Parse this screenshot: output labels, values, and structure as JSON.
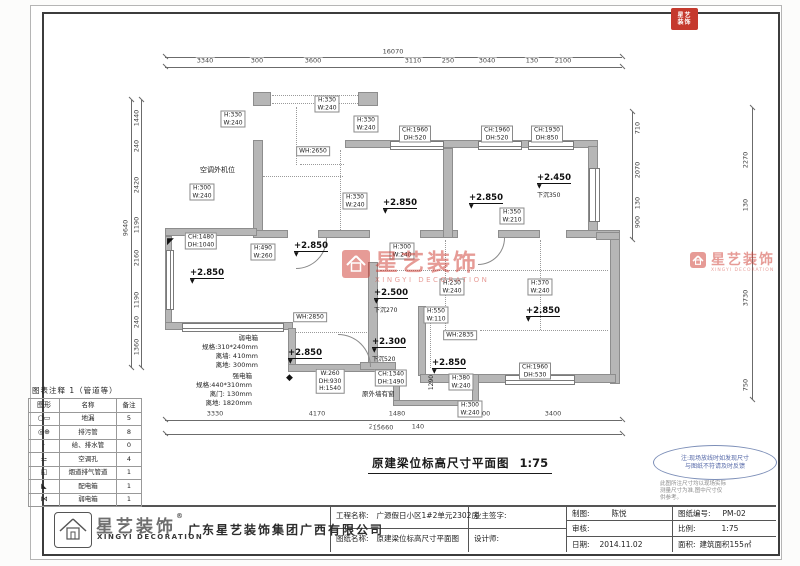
{
  "stamp": {
    "lines": [
      "星艺",
      "装饰"
    ],
    "color": "#c5392d"
  },
  "watermark": {
    "cn": "星艺装饰",
    "en": "XINGYI DECORATION",
    "color": "#cf3a30"
  },
  "title": {
    "text": "原建梁位标高尺寸平面图",
    "scale": "1:75"
  },
  "note": {
    "ellipse": [
      "注:现场放线时如发现尺寸",
      "与图纸不符请及时反馈"
    ],
    "small": [
      "此图所注尺寸均以现场实际",
      "测量尺寸为准,图中尺寸仅",
      "供参考。"
    ]
  },
  "legend": {
    "title": "图表注释 1（管道等）",
    "headers": [
      "图形",
      "名称",
      "备注"
    ],
    "rows": [
      {
        "icon": "○▭",
        "name": "地漏",
        "count": "5"
      },
      {
        "icon": "◎⊕",
        "name": "排污管",
        "count": "8"
      },
      {
        "icon": "·",
        "name": "给、排水管",
        "count": "0"
      },
      {
        "icon": "⚍",
        "name": "空调孔",
        "count": "4"
      },
      {
        "icon": "◱",
        "name": "烟道排气管道",
        "count": "1"
      },
      {
        "icon": "◣",
        "name": "配电箱",
        "count": "1"
      },
      {
        "icon": "⋈",
        "name": "弱电箱",
        "count": "1"
      }
    ]
  },
  "titleblock": {
    "company": "广东星艺装饰集团广西有限公司",
    "brand_cn": "星艺装饰",
    "brand_en": "XINGYI DECORATION",
    "reg": "®",
    "project_label": "工程名称:",
    "project": "广源假日小区1#2单元2302房",
    "drawing_label": "图纸名称:",
    "drawing": "原建梁位标高尺寸平面图",
    "owner_label": "业主签字:",
    "designer_label": "设计师:",
    "draft_label": "制图:",
    "draft": "陈悦",
    "audit_label": "审核:",
    "audit": "",
    "date_label": "日期:",
    "date": "2014.11.02",
    "no_label": "图纸编号:",
    "no": "PM-02",
    "scale_label": "比例:",
    "scale": "1:75",
    "area_label": "面积:",
    "area": "建筑面积155㎡"
  },
  "dims": {
    "chains": [
      {
        "name": "top",
        "rot": false,
        "lines": [
          [
            165,
            57,
            457,
            "h"
          ],
          [
            165,
            67,
            457,
            "h"
          ]
        ],
        "labels": [
          {
            "t": "16070",
            "x": 393,
            "y": 52
          },
          {
            "t": "3340",
            "x": 205,
            "y": 61
          },
          {
            "t": "300",
            "x": 257,
            "y": 61
          },
          {
            "t": "3600",
            "x": 313,
            "y": 61
          },
          {
            "t": "3110",
            "x": 413,
            "y": 61
          },
          {
            "t": "250",
            "x": 448,
            "y": 61
          },
          {
            "t": "3040",
            "x": 487,
            "y": 61
          },
          {
            "t": "130",
            "x": 532,
            "y": 61
          },
          {
            "t": "2100",
            "x": 563,
            "y": 61
          }
        ]
      },
      {
        "name": "bottom",
        "rot": false,
        "lines": [
          [
            165,
            420,
            457,
            "h"
          ],
          [
            165,
            434,
            457,
            "h"
          ]
        ],
        "labels": [
          {
            "t": "3330",
            "x": 215,
            "y": 414
          },
          {
            "t": "4170",
            "x": 317,
            "y": 414
          },
          {
            "t": "1480",
            "x": 397,
            "y": 414
          },
          {
            "t": "3000",
            "x": 482,
            "y": 414
          },
          {
            "t": "3400",
            "x": 553,
            "y": 414
          },
          {
            "t": "240",
            "x": 375,
            "y": 427
          },
          {
            "t": "140",
            "x": 418,
            "y": 427
          },
          {
            "t": "15660",
            "x": 383,
            "y": 428
          }
        ]
      },
      {
        "name": "left",
        "rot": true,
        "lines": [
          [
            131,
            100,
            268,
            "v"
          ],
          [
            141,
            100,
            268,
            "v"
          ]
        ],
        "labels": [
          {
            "t": "9640",
            "x": 126,
            "y": 228
          },
          {
            "t": "1440",
            "x": 137,
            "y": 118
          },
          {
            "t": "240",
            "x": 137,
            "y": 146
          },
          {
            "t": "2420",
            "x": 137,
            "y": 185
          },
          {
            "t": "1190",
            "x": 137,
            "y": 225
          },
          {
            "t": "2160",
            "x": 137,
            "y": 258
          },
          {
            "t": "1190",
            "x": 137,
            "y": 300
          },
          {
            "t": "240",
            "x": 137,
            "y": 322
          },
          {
            "t": "1360",
            "x": 137,
            "y": 347
          }
        ]
      },
      {
        "name": "right-inner",
        "rot": true,
        "lines": [
          [
            632,
            112,
            128,
            "v"
          ]
        ],
        "labels": [
          {
            "t": "710",
            "x": 638,
            "y": 128
          },
          {
            "t": "2070",
            "x": 638,
            "y": 170
          },
          {
            "t": "130",
            "x": 638,
            "y": 203
          },
          {
            "t": "900",
            "x": 638,
            "y": 222
          }
        ]
      },
      {
        "name": "right-outer",
        "rot": true,
        "lines": [
          [
            752,
            108,
            292,
            "v"
          ]
        ],
        "labels": [
          {
            "t": "2270",
            "x": 746,
            "y": 160
          },
          {
            "t": "130",
            "x": 746,
            "y": 205
          },
          {
            "t": "3730",
            "x": 746,
            "y": 298
          },
          {
            "t": "750",
            "x": 746,
            "y": 385
          }
        ]
      }
    ]
  },
  "plan": {
    "walls": [
      [
        253,
        92,
        18,
        14
      ],
      [
        358,
        92,
        20,
        14
      ],
      [
        253,
        140,
        10,
        98
      ],
      [
        345,
        140,
        253,
        8
      ],
      [
        588,
        146,
        10,
        92
      ],
      [
        253,
        230,
        35,
        8
      ],
      [
        318,
        230,
        52,
        8
      ],
      [
        420,
        230,
        38,
        8
      ],
      [
        498,
        230,
        42,
        8
      ],
      [
        566,
        230,
        54,
        8
      ],
      [
        165,
        228,
        92,
        8
      ],
      [
        165,
        236,
        7,
        92
      ],
      [
        165,
        322,
        128,
        8
      ],
      [
        288,
        328,
        8,
        44
      ],
      [
        288,
        364,
        108,
        8
      ],
      [
        443,
        148,
        10,
        90
      ],
      [
        368,
        262,
        10,
        104
      ],
      [
        360,
        362,
        36,
        8
      ],
      [
        418,
        306,
        8,
        70
      ],
      [
        610,
        236,
        10,
        148
      ],
      [
        596,
        232,
        24,
        8
      ],
      [
        420,
        374,
        196,
        9
      ],
      [
        393,
        374,
        7,
        30
      ],
      [
        393,
        400,
        86,
        6
      ],
      [
        472,
        374,
        7,
        32
      ]
    ],
    "windows": [
      [
        390,
        141,
        52,
        7,
        "h"
      ],
      [
        478,
        141,
        42,
        7,
        "h"
      ],
      [
        528,
        141,
        44,
        7,
        "h"
      ],
      [
        166,
        250,
        6,
        58,
        "v"
      ],
      [
        182,
        323,
        100,
        7,
        "h"
      ],
      [
        505,
        375,
        68,
        8,
        "h"
      ],
      [
        589,
        168,
        9,
        52,
        "v"
      ]
    ],
    "dotted": [
      [
        272,
        95,
        88,
        "h"
      ],
      [
        272,
        103,
        88,
        "h"
      ],
      [
        296,
        107,
        58,
        "v"
      ],
      [
        300,
        164,
        44,
        "h"
      ],
      [
        263,
        176,
        80,
        "h"
      ],
      [
        340,
        150,
        82,
        "v"
      ],
      [
        380,
        270,
        228,
        "h"
      ],
      [
        445,
        240,
        92,
        "v"
      ],
      [
        540,
        240,
        90,
        "v"
      ],
      [
        295,
        332,
        72,
        "h"
      ],
      [
        430,
        308,
        60,
        "v"
      ],
      [
        480,
        330,
        128,
        "h"
      ]
    ],
    "doors": [
      {
        "x": 296,
        "y": 238,
        "r": 30,
        "dir": "br"
      },
      {
        "x": 338,
        "y": 334,
        "r": 32,
        "dir": "tr"
      },
      {
        "x": 478,
        "y": 238,
        "r": 26,
        "dir": "br"
      }
    ],
    "boxed_labels": [
      {
        "x": 233,
        "y": 119,
        "lines": [
          "H:330",
          "W:240"
        ]
      },
      {
        "x": 327,
        "y": 104,
        "lines": [
          "H:330",
          "W:240"
        ]
      },
      {
        "x": 366,
        "y": 124,
        "lines": [
          "H:330",
          "W:240"
        ]
      },
      {
        "x": 415,
        "y": 134,
        "lines": [
          "CH:1960",
          "DH:520"
        ]
      },
      {
        "x": 497,
        "y": 134,
        "lines": [
          "CH:1960",
          "DH:520"
        ]
      },
      {
        "x": 547,
        "y": 134,
        "lines": [
          "CH:1930",
          "DH:850"
        ]
      },
      {
        "x": 313,
        "y": 151,
        "lines": [
          "WH:2650"
        ]
      },
      {
        "x": 202,
        "y": 192,
        "lines": [
          "H:300",
          "W:240"
        ]
      },
      {
        "x": 355,
        "y": 201,
        "lines": [
          "H:330",
          "W:240"
        ]
      },
      {
        "x": 512,
        "y": 216,
        "lines": [
          "H:350",
          "W:210"
        ]
      },
      {
        "x": 201,
        "y": 241,
        "lines": [
          "CH:1480",
          "DH:1040"
        ]
      },
      {
        "x": 263,
        "y": 252,
        "lines": [
          "H:490",
          "W:260"
        ]
      },
      {
        "x": 402,
        "y": 251,
        "lines": [
          "H:300",
          "W:240"
        ]
      },
      {
        "x": 452,
        "y": 287,
        "lines": [
          "H:230",
          "W:240"
        ]
      },
      {
        "x": 436,
        "y": 315,
        "lines": [
          "H:550",
          "W:110"
        ]
      },
      {
        "x": 540,
        "y": 287,
        "lines": [
          "H:370",
          "W:240"
        ]
      },
      {
        "x": 310,
        "y": 317,
        "lines": [
          "WH:2850"
        ]
      },
      {
        "x": 460,
        "y": 335,
        "lines": [
          "WH:2835"
        ]
      },
      {
        "x": 330,
        "y": 381,
        "lines": [
          "W:260",
          "DH:930",
          "H:1540"
        ]
      },
      {
        "x": 391,
        "y": 378,
        "lines": [
          "CH:1340",
          "DH:1490"
        ]
      },
      {
        "x": 535,
        "y": 371,
        "lines": [
          "CH:1960",
          "DH:530"
        ]
      },
      {
        "x": 461,
        "y": 382,
        "lines": [
          "H:380",
          "W:240"
        ]
      },
      {
        "x": 470,
        "y": 409,
        "lines": [
          "H:300",
          "W:240"
        ]
      }
    ],
    "texts": [
      {
        "x": 200,
        "y": 166,
        "lines": [
          "空调外机位"
        ],
        "size": 7
      },
      {
        "x": 362,
        "y": 390,
        "lines": [
          "原外墙有窗"
        ],
        "size": 6.5
      },
      {
        "x": 178,
        "y": 334,
        "w": 80,
        "align": "right",
        "size": 6.5,
        "lines": [
          "弱电箱",
          "规格:310*240mm",
          "离墙: 410mm",
          "离地: 300mm"
        ]
      },
      {
        "x": 168,
        "y": 372,
        "w": 84,
        "align": "right",
        "size": 6.5,
        "lines": [
          "强电箱",
          "规格:440*310mm",
          "离门: 130mm",
          "离地: 1820mm"
        ]
      },
      {
        "x": 424,
        "y": 378,
        "lines": [
          "1290"
        ],
        "size": 6,
        "rot": true
      }
    ],
    "elevations": [
      {
        "v": "+2.850",
        "x": 400,
        "y": 190
      },
      {
        "v": "+2.850",
        "x": 486,
        "y": 185
      },
      {
        "v": "+2.450",
        "x": 554,
        "y": 165,
        "n": "下沉350"
      },
      {
        "v": "+2.850",
        "x": 311,
        "y": 233
      },
      {
        "v": "+2.850",
        "x": 207,
        "y": 260
      },
      {
        "v": "+2.500",
        "x": 391,
        "y": 280,
        "n": "下沉270"
      },
      {
        "v": "+2.850",
        "x": 305,
        "y": 340
      },
      {
        "v": "+2.300",
        "x": 389,
        "y": 329,
        "n": "下沉520"
      },
      {
        "v": "+2.850",
        "x": 449,
        "y": 350
      },
      {
        "v": "+2.850",
        "x": 543,
        "y": 298
      }
    ],
    "black_marks": [
      {
        "x": 167,
        "y": 238,
        "g": "◤"
      },
      {
        "x": 286,
        "y": 374,
        "g": "◆"
      }
    ]
  }
}
